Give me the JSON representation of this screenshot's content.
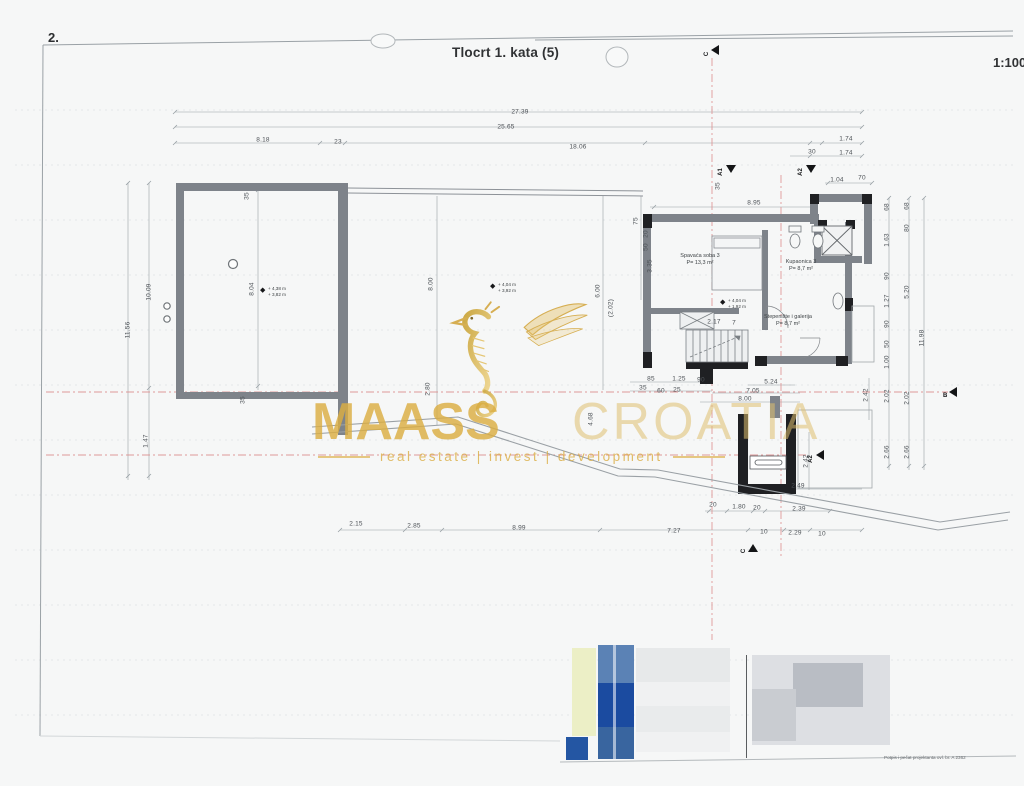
{
  "page": {
    "number": "2.",
    "title": "Tlocrt 1. kata (5)",
    "scale": "1:100"
  },
  "watermark": {
    "brand_bold": "MAASS",
    "brand_light": "CROATIA",
    "tagline": "real estate | invest | development"
  },
  "rooms": [
    {
      "name": "Spavaća soba 3",
      "area": "P= 13,3 m²",
      "x": 700,
      "y": 260
    },
    {
      "name": "Kupaonica 3",
      "area": "P= 8,7 m²",
      "x": 801,
      "y": 266
    },
    {
      "name": "Stepenište i galerija",
      "area": "P= 8,7 m²",
      "x": 788,
      "y": 321
    }
  ],
  "elevations": [
    {
      "lines": [
        "+ 4,38 m",
        "+ 3,82 m"
      ],
      "x": 268,
      "y": 291
    },
    {
      "lines": [
        "+ 4,04 m",
        "+ 3,92 m"
      ],
      "x": 498,
      "y": 287
    },
    {
      "lines": [
        "+ 4,04 m",
        "+ 1,92 m"
      ],
      "x": 728,
      "y": 303
    }
  ],
  "dimensions": [
    {
      "t": "27.39",
      "x": 520,
      "y": 112
    },
    {
      "t": "25.65",
      "x": 506,
      "y": 127
    },
    {
      "t": "8.18",
      "x": 263,
      "y": 140
    },
    {
      "t": "23",
      "x": 338,
      "y": 142
    },
    {
      "t": "18.06",
      "x": 578,
      "y": 147
    },
    {
      "t": "1.74",
      "x": 846,
      "y": 139
    },
    {
      "t": "30",
      "x": 812,
      "y": 152
    },
    {
      "t": "1.74",
      "x": 846,
      "y": 153
    },
    {
      "t": "1.04",
      "x": 837,
      "y": 180
    },
    {
      "t": "70",
      "x": 862,
      "y": 178
    },
    {
      "t": "8.95",
      "x": 754,
      "y": 203
    },
    {
      "t": "35",
      "x": 718,
      "y": 186,
      "r": 1
    },
    {
      "t": "11.56",
      "x": 128,
      "y": 330,
      "r": 1
    },
    {
      "t": "10.09",
      "x": 149,
      "y": 292,
      "r": 1
    },
    {
      "t": "1.47",
      "x": 146,
      "y": 441,
      "r": 1
    },
    {
      "t": "8.04",
      "x": 252,
      "y": 289,
      "r": 1
    },
    {
      "t": "35",
      "x": 247,
      "y": 196,
      "r": 1
    },
    {
      "t": "35",
      "x": 243,
      "y": 400,
      "r": 1
    },
    {
      "t": "8.00",
      "x": 431,
      "y": 284,
      "r": 1
    },
    {
      "t": "2.80",
      "x": 428,
      "y": 389,
      "r": 1
    },
    {
      "t": "6.00",
      "x": 598,
      "y": 291,
      "r": 1
    },
    {
      "t": "4.68",
      "x": 591,
      "y": 419,
      "r": 1
    },
    {
      "t": "(2.02)",
      "x": 611,
      "y": 308,
      "r": 1
    },
    {
      "t": "3.35",
      "x": 650,
      "y": 266,
      "r": 1
    },
    {
      "t": "75",
      "x": 636,
      "y": 221,
      "r": 1
    },
    {
      "t": "20",
      "x": 646,
      "y": 234,
      "r": 1
    },
    {
      "t": "50",
      "x": 646,
      "y": 247,
      "r": 1
    },
    {
      "t": "68",
      "x": 887,
      "y": 207,
      "r": 1
    },
    {
      "t": "1.63",
      "x": 887,
      "y": 240,
      "r": 1
    },
    {
      "t": "90",
      "x": 887,
      "y": 276,
      "r": 1
    },
    {
      "t": "1.27",
      "x": 887,
      "y": 301,
      "r": 1
    },
    {
      "t": "90",
      "x": 887,
      "y": 324,
      "r": 1
    },
    {
      "t": "50",
      "x": 887,
      "y": 344,
      "r": 1
    },
    {
      "t": "1.00",
      "x": 887,
      "y": 362,
      "r": 1
    },
    {
      "t": "2.02",
      "x": 887,
      "y": 396,
      "r": 1
    },
    {
      "t": "2.66",
      "x": 887,
      "y": 452,
      "r": 1
    },
    {
      "t": "68",
      "x": 907,
      "y": 206,
      "r": 1
    },
    {
      "t": "80",
      "x": 907,
      "y": 228,
      "r": 1
    },
    {
      "t": "5.20",
      "x": 907,
      "y": 292,
      "r": 1
    },
    {
      "t": "2.02",
      "x": 907,
      "y": 398,
      "r": 1
    },
    {
      "t": "2.66",
      "x": 907,
      "y": 452,
      "r": 1
    },
    {
      "t": "11.98",
      "x": 922,
      "y": 338,
      "r": 1
    },
    {
      "t": "2.42",
      "x": 866,
      "y": 395,
      "r": 1
    },
    {
      "t": "2.42",
      "x": 806,
      "y": 461,
      "r": 1
    },
    {
      "t": "2.17",
      "x": 714,
      "y": 322
    },
    {
      "t": "7",
      "x": 734,
      "y": 323
    },
    {
      "t": "85",
      "x": 651,
      "y": 379
    },
    {
      "t": "1.25",
      "x": 679,
      "y": 379
    },
    {
      "t": "90",
      "x": 701,
      "y": 380
    },
    {
      "t": "35",
      "x": 643,
      "y": 388
    },
    {
      "t": "60",
      "x": 661,
      "y": 391
    },
    {
      "t": "25",
      "x": 677,
      "y": 390
    },
    {
      "t": "5.24",
      "x": 771,
      "y": 382
    },
    {
      "t": "7.05",
      "x": 753,
      "y": 391
    },
    {
      "t": "8.00",
      "x": 745,
      "y": 399
    },
    {
      "t": "2.49",
      "x": 798,
      "y": 486
    },
    {
      "t": "20",
      "x": 713,
      "y": 505
    },
    {
      "t": "1.80",
      "x": 739,
      "y": 507
    },
    {
      "t": "20",
      "x": 757,
      "y": 508
    },
    {
      "t": "2.39",
      "x": 799,
      "y": 509
    },
    {
      "t": "2.15",
      "x": 356,
      "y": 524
    },
    {
      "t": "2.85",
      "x": 414,
      "y": 526
    },
    {
      "t": "8.99",
      "x": 519,
      "y": 528
    },
    {
      "t": "7.27",
      "x": 674,
      "y": 531
    },
    {
      "t": "10",
      "x": 764,
      "y": 532
    },
    {
      "t": "2.29",
      "x": 795,
      "y": 533
    },
    {
      "t": "10",
      "x": 822,
      "y": 534
    }
  ],
  "section_markers": [
    {
      "label": "C",
      "x": 710,
      "y": 50,
      "dir": "left",
      "rot": 1
    },
    {
      "label": "A1",
      "x": 722,
      "y": 170,
      "dir": "down",
      "rot": 1
    },
    {
      "label": "A2",
      "x": 802,
      "y": 170,
      "dir": "down",
      "rot": 1
    },
    {
      "label": "B",
      "x": 948,
      "y": 392,
      "dir": "left",
      "rot": 0
    },
    {
      "label": "A2",
      "x": 812,
      "y": 455,
      "dir": "left",
      "rot": 1
    },
    {
      "label": "C",
      "x": 747,
      "y": 549,
      "dir": "up",
      "rot": 1
    }
  ],
  "title_block": {
    "stamp_note": "Potpis i pečat projektanta   ovl. br. A 2362"
  },
  "colors": {
    "wall_gray": "#7e838a",
    "wall_black": "#1f2023",
    "line": "#98a0a5",
    "section_red": "#dd8f8f",
    "gold": "#d8ae3e",
    "block_blue": "#1f4f9c"
  }
}
